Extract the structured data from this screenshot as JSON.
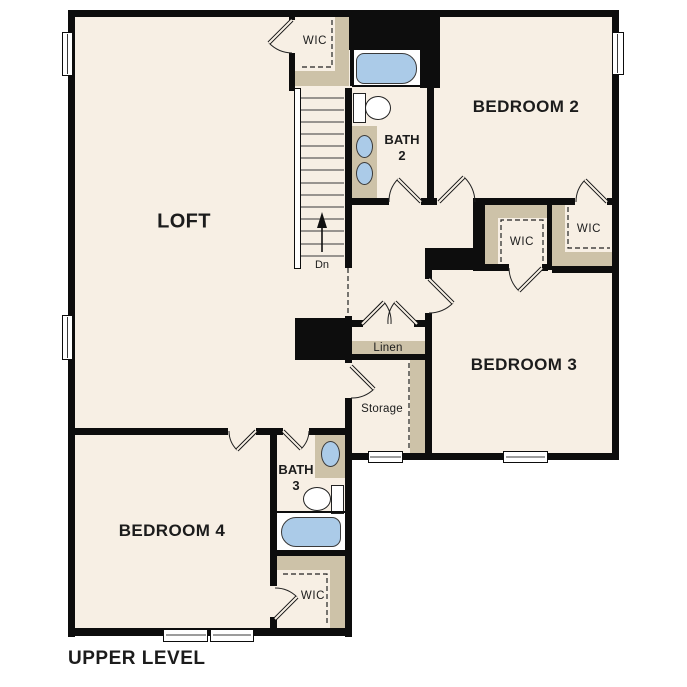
{
  "plan": {
    "title": "UPPER LEVEL",
    "labels": {
      "loft": "LOFT",
      "bedroom2": "BEDROOM 2",
      "bedroom3": "BEDROOM 3",
      "bedroom4": "BEDROOM 4",
      "bath2_name": "BATH",
      "bath2_num": "2",
      "bath3_name": "BATH",
      "bath3_num": "3",
      "wic_top": "WIC",
      "wic_bedroom3": "WIC",
      "wic_bedroom2": "WIC",
      "wic_bedroom4": "WIC",
      "linen": "Linen",
      "storage": "Storage",
      "stair_direction": "Dn"
    },
    "colors": {
      "floor": "#f7efe4",
      "wall": "#0d0d0d",
      "casework": "#cdc2a8",
      "water_fixture": "#abcbe8",
      "ink": "#1c1c1c",
      "background": "#ffffff"
    }
  }
}
